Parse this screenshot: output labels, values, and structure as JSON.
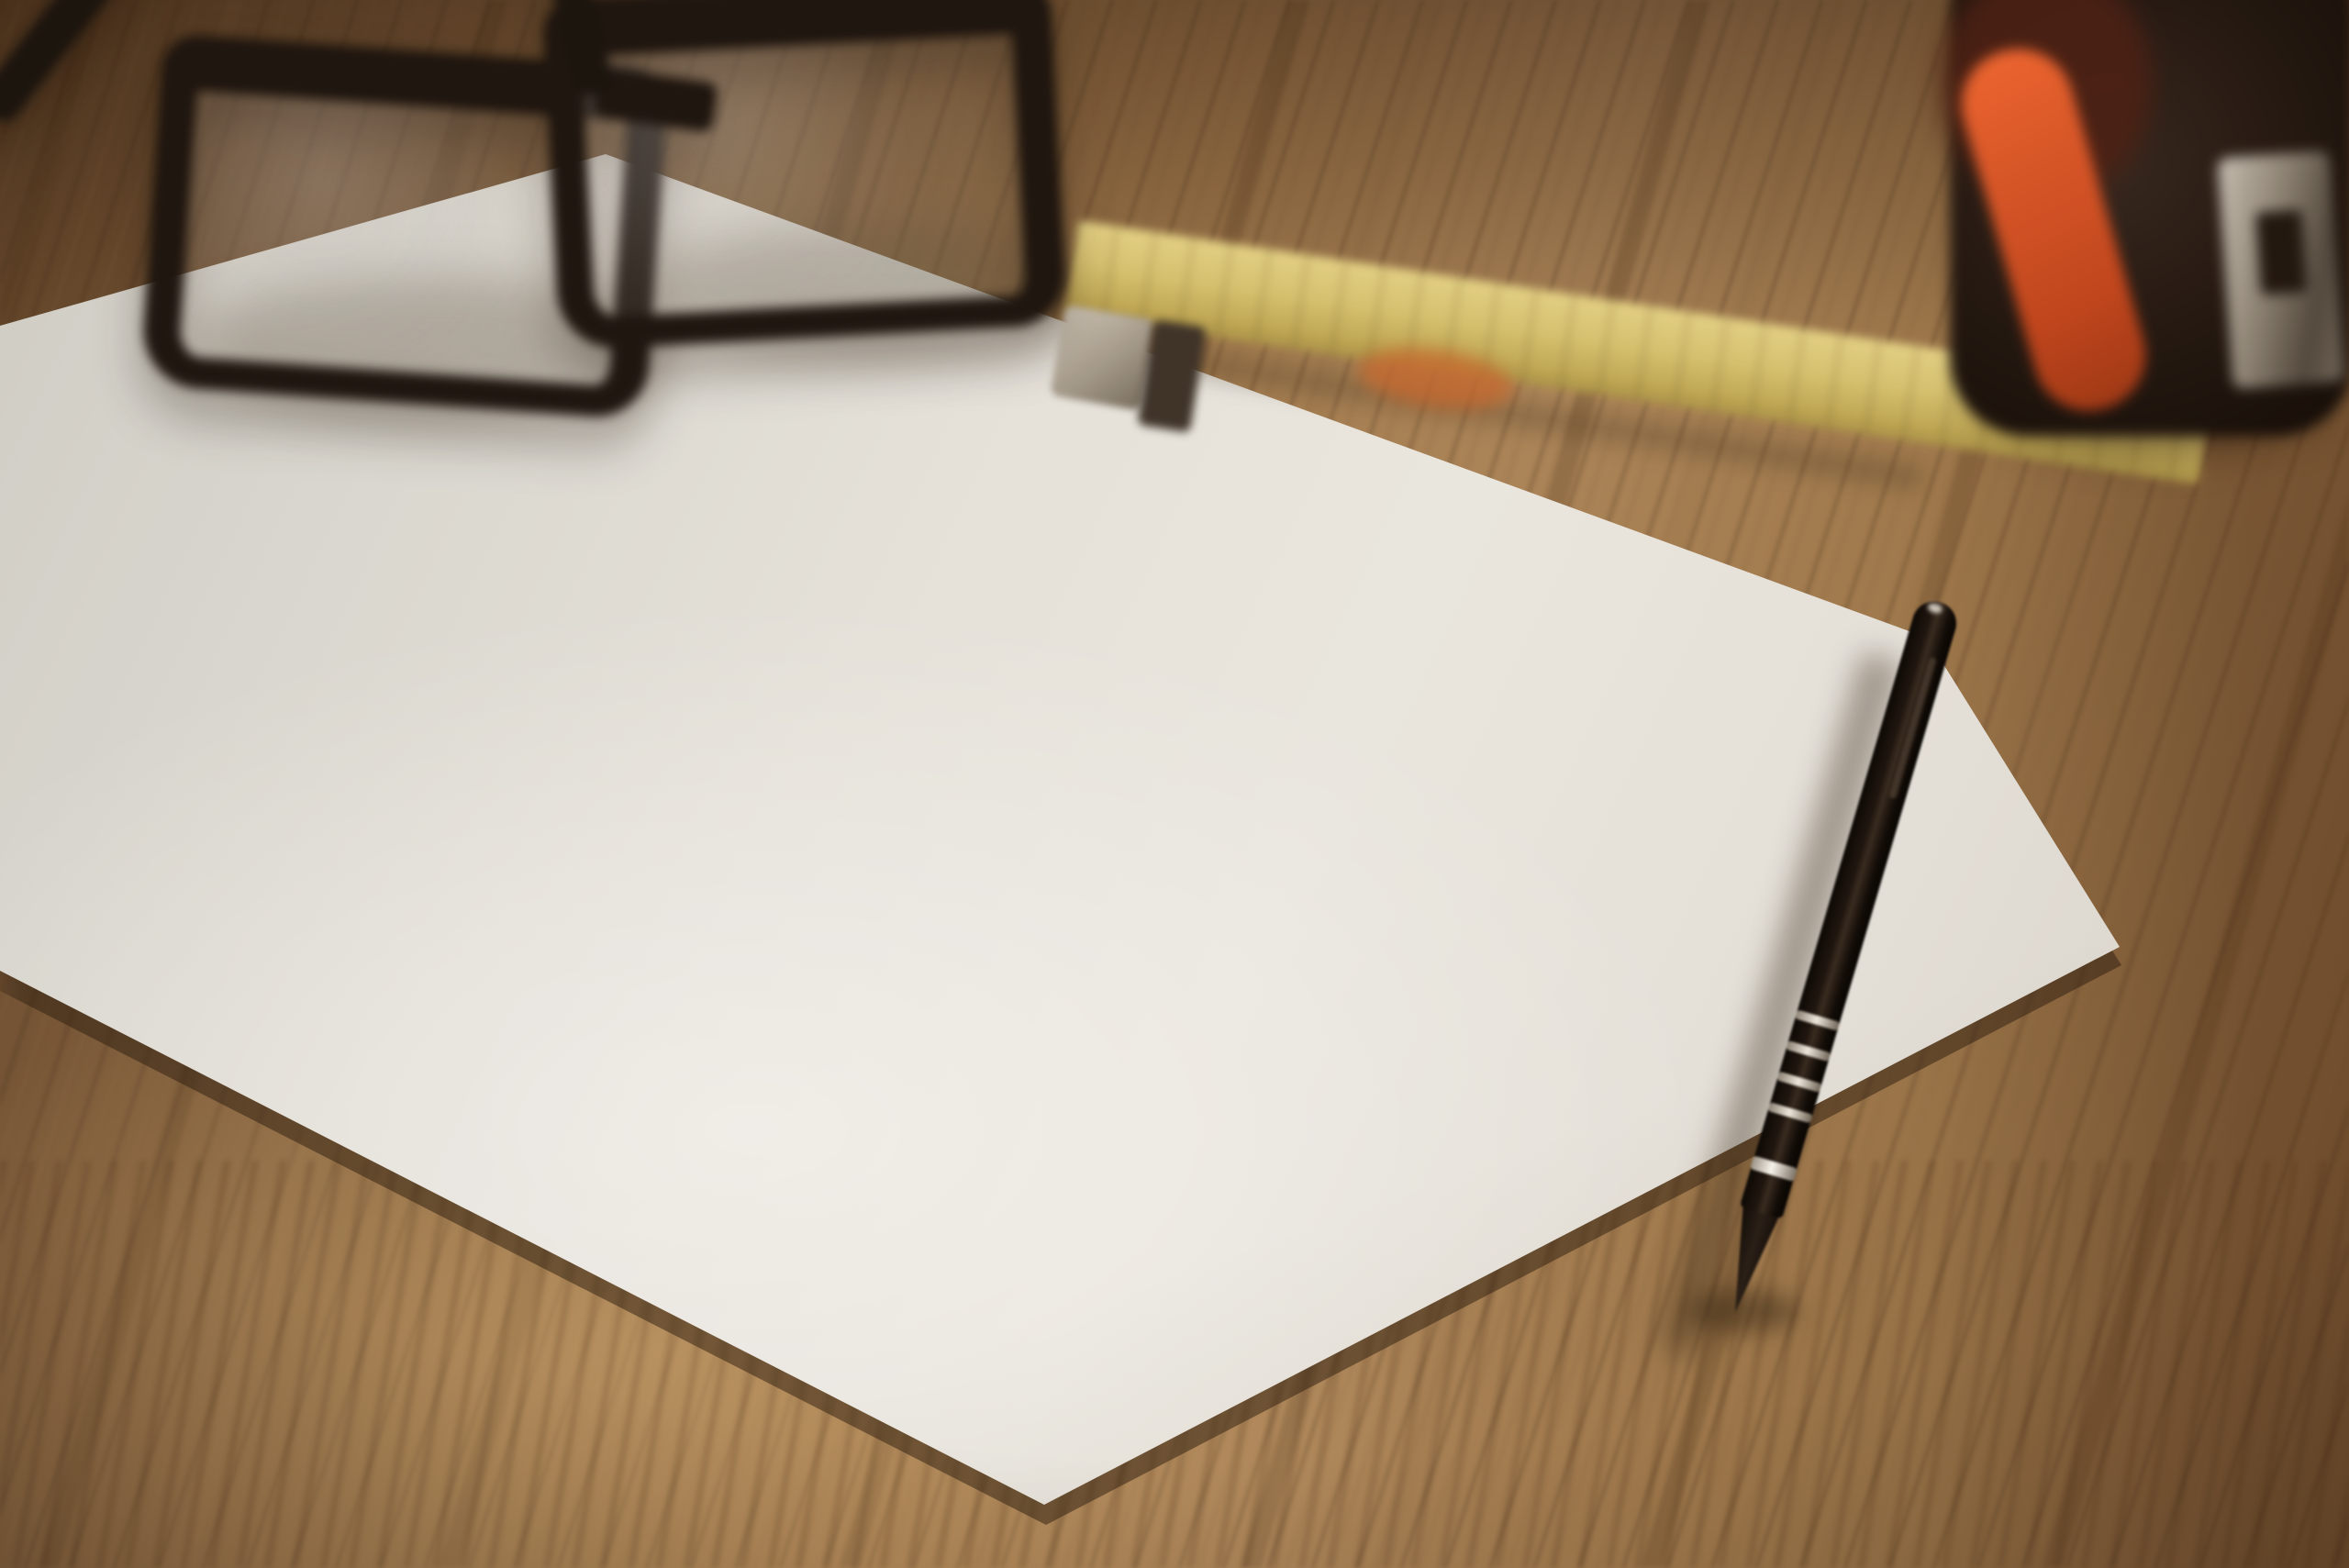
{
  "plan": {
    "title": "1st Floor Plan",
    "rooms": {
      "bedroom_left": {
        "name": "BED ROOM",
        "dims": "14x13'"
      },
      "bedroom_right": {
        "name": "BED ROOM",
        "dims": "13'x15'"
      },
      "bedroom_top": {
        "name": "BED ROOM",
        "dims": "13'x 12'6\""
      },
      "kitchen": {
        "name": "KITCHEN",
        "dims": "6'11\"x7'"
      },
      "dining": {
        "name": "DINING",
        "dims": "11'6\"x12'6\""
      },
      "balcony_left": {
        "name": "BALCONY",
        "dims": "10'x3'"
      },
      "balcony_mid": {
        "name": "BALCONY",
        "dims": "9'x3'6\""
      },
      "balcony_right": {
        "name": "BALCONY",
        "dims": "x3'6\""
      }
    },
    "markers": {
      "w1": "W1",
      "w2": "W2",
      "w3": "W3",
      "d2": "D2",
      "d3": "D3"
    }
  },
  "colors": {
    "paper": "#e9e8e3",
    "ink": "#413d35",
    "wall": "#5b574e",
    "wood_light": "#ab855a",
    "wood_dark": "#5e4329",
    "blade_yellow": "#d8c572",
    "tape_orange": "#e55a28",
    "pen_black": "#17100c"
  }
}
